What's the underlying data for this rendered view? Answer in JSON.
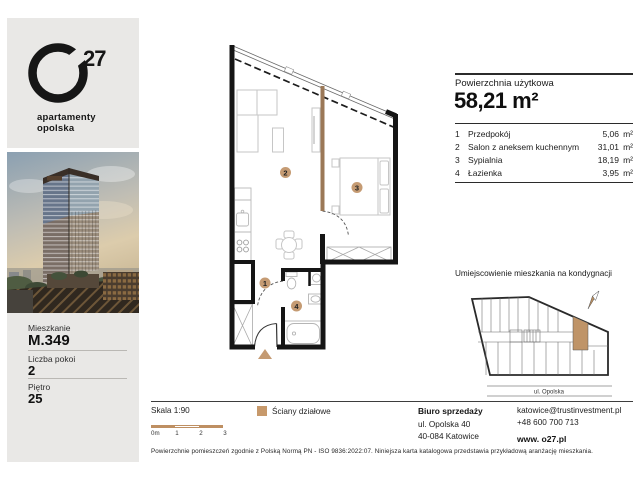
{
  "colors": {
    "accent": "#C49A72",
    "partition": "#9B7857",
    "wall": "#151515",
    "panel_bg": "#E9E8E6"
  },
  "brand": {
    "logo_number": "27",
    "sub1": "apartamenty",
    "sub2": "opolska"
  },
  "apartment": {
    "mieszkanie_label": "Mieszkanie",
    "mieszkanie_value": "M.349",
    "pokoje_label": "Liczba pokoi",
    "pokoje_value": "2",
    "pietro_label": "Piętro",
    "pietro_value": "25"
  },
  "area": {
    "label": "Powierzchnia użytkowa",
    "value": "58,21 m²"
  },
  "rooms": [
    {
      "no": "1",
      "name": "Przedpokój",
      "area": "5,06",
      "unit": "m²"
    },
    {
      "no": "2",
      "name": "Salon z aneksem kuchennym",
      "area": "31,01",
      "unit": "m²"
    },
    {
      "no": "3",
      "name": "Sypialnia",
      "area": "18,19",
      "unit": "m²"
    },
    {
      "no": "4",
      "name": "Łazienka",
      "area": "3,95",
      "unit": "m²"
    }
  ],
  "plan": {
    "markers": [
      "1",
      "2",
      "3",
      "4"
    ]
  },
  "location": {
    "title": "Umiejscowienie mieszkania na kondygnacji",
    "street": "ul. Opolska"
  },
  "footer": {
    "scale_label": "Skala 1:90",
    "scale_ticks": [
      "0m",
      "1",
      "2",
      "3"
    ],
    "legend_label": "Ściany działowe",
    "office_title": "Biuro sprzedaży",
    "office_line1": "ul. Opolska 40",
    "office_line2": "40-084 Katowice",
    "email": "katowice@trustinvestment.pl",
    "phone": "+48 600 700 713",
    "website": "www. o27.pl",
    "disclaimer": "Powierzchnie pomieszczeń zgodnie z Polską Normą PN - ISO 9836:2022:07. Niniejsza karta katalogowa przedstawia przykładową aranżację mieszkania."
  }
}
